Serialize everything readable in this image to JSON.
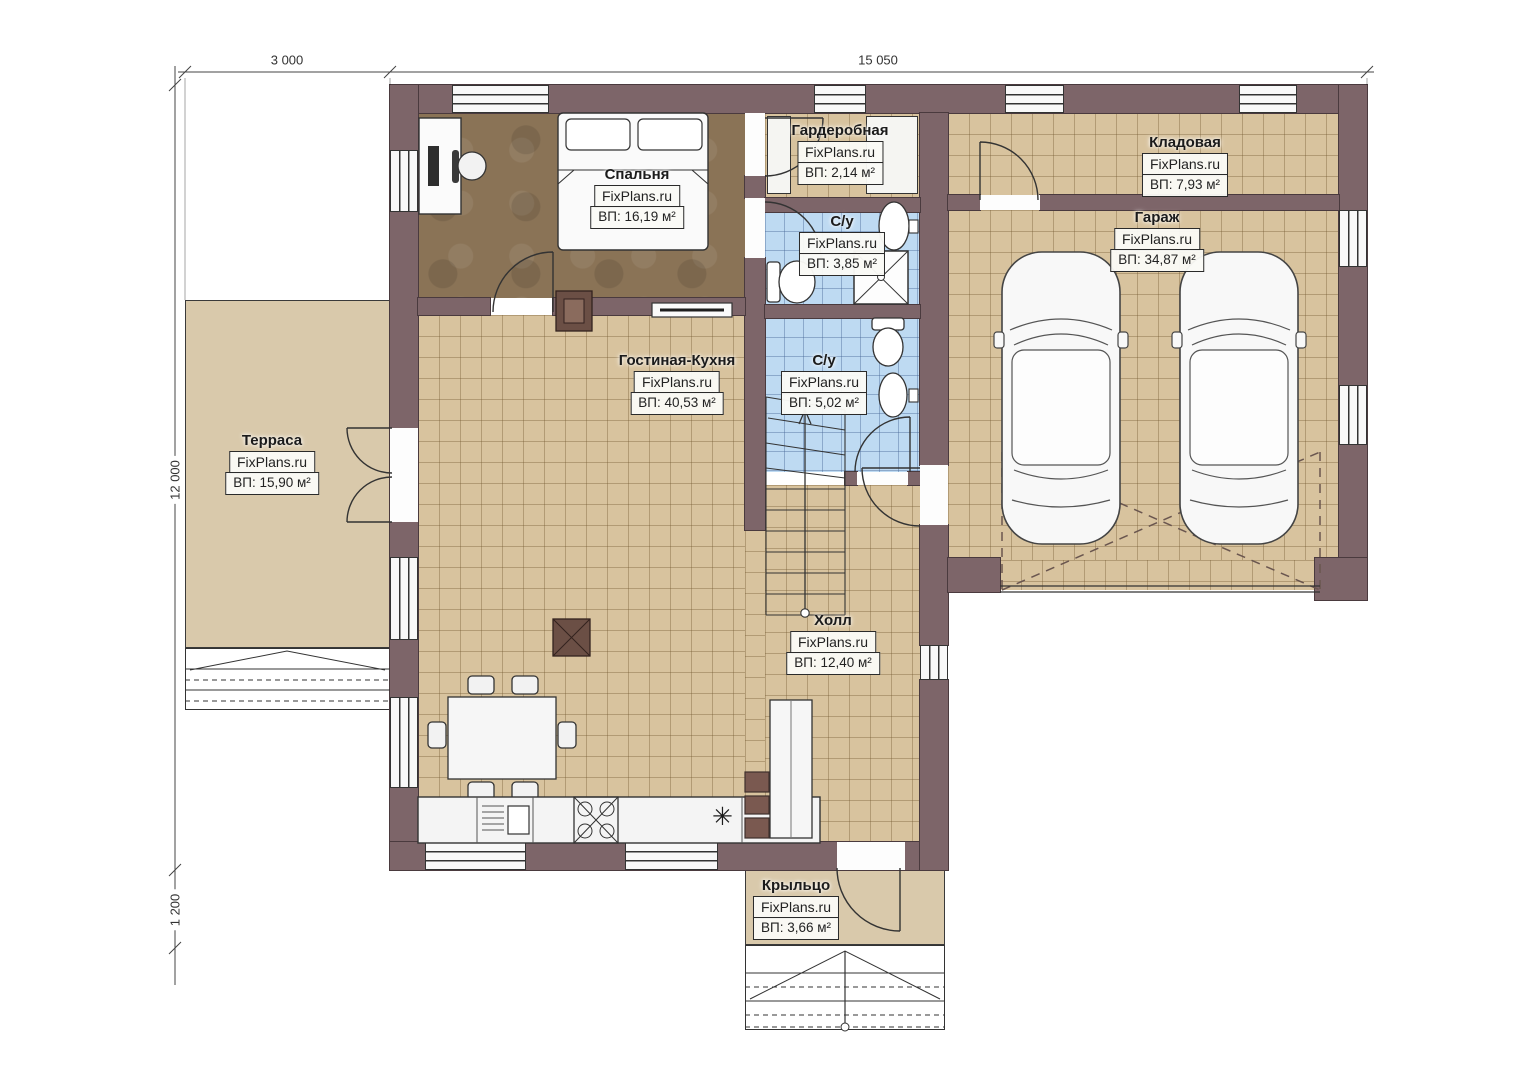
{
  "watermark": "FixPlans.ru",
  "dimensions": {
    "top_left": "3 000",
    "top_right": "15 050",
    "left": "12 000",
    "bottom_left": "1 200"
  },
  "rooms": [
    {
      "name": "Спальня",
      "brand": "FixPlans.ru",
      "area": "ВП: 16,19 м²"
    },
    {
      "name": "Гардеробная",
      "brand": "FixPlans.ru",
      "area": "ВП: 2,14 м²"
    },
    {
      "name": "С/у",
      "brand": "FixPlans.ru",
      "area": "ВП: 3,85 м²"
    },
    {
      "name": "Кладовая",
      "brand": "FixPlans.ru",
      "area": "ВП: 7,93 м²"
    },
    {
      "name": "Гараж",
      "brand": "FixPlans.ru",
      "area": "ВП: 34,87 м²"
    },
    {
      "name": "Гостиная-Кухня",
      "brand": "FixPlans.ru",
      "area": "ВП: 40,53 м²"
    },
    {
      "name": "С/у",
      "brand": "FixPlans.ru",
      "area": "ВП: 5,02 м²"
    },
    {
      "name": "Терраса",
      "brand": "FixPlans.ru",
      "area": "ВП: 15,90 м²"
    },
    {
      "name": "Холл",
      "brand": "FixPlans.ru",
      "area": "ВП: 12,40 м²"
    },
    {
      "name": "Крыльцо",
      "brand": "FixPlans.ru",
      "area": "ВП: 3,66 м²"
    }
  ],
  "colors": {
    "wall": "#7d6569",
    "floor_tile": "#d8c39e",
    "floor_wood": "#8a7356",
    "floor_bath": "#bedaf2",
    "terrace": "#d9c9ab",
    "accent_dark": "#6b4f45"
  },
  "symbols": {
    "kitchen_star": "✳"
  }
}
